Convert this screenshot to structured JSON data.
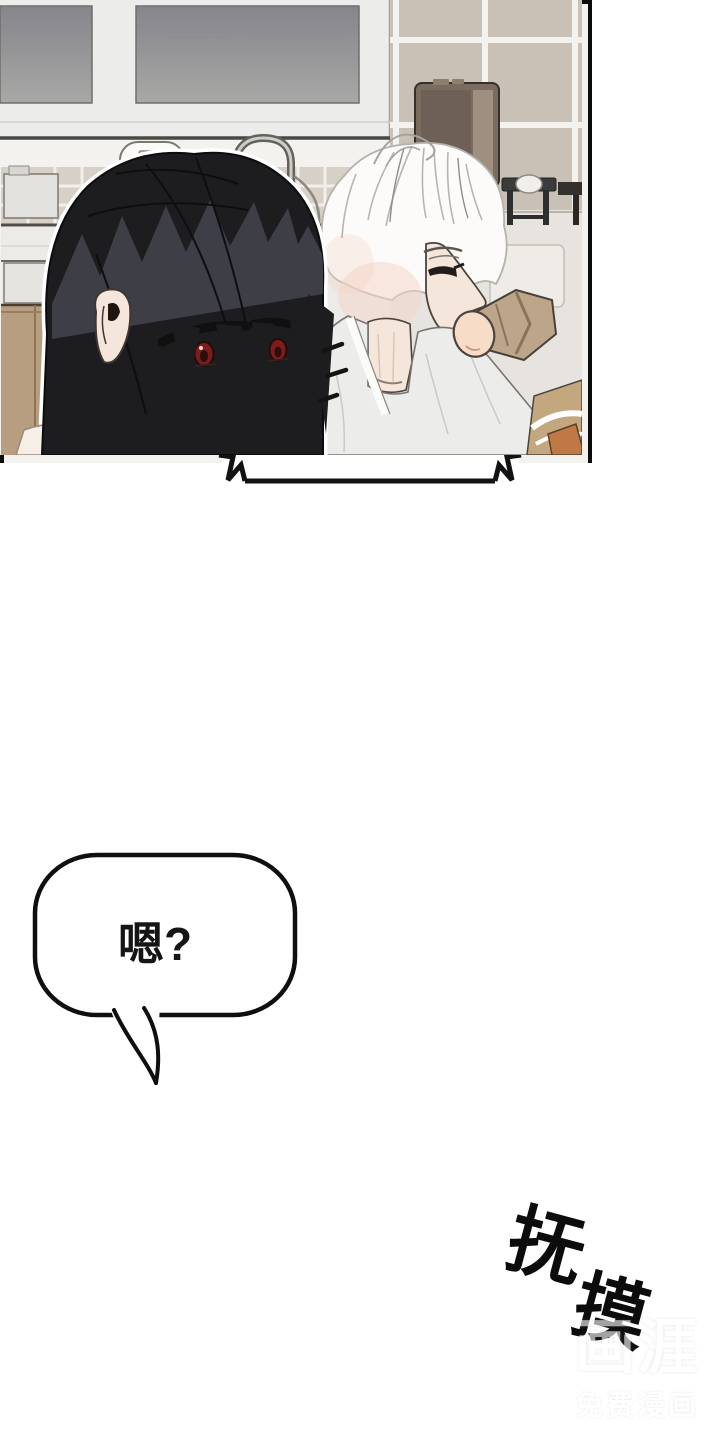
{
  "page": {
    "width": 720,
    "height": 1440,
    "type": "webtoon-comic-page"
  },
  "sfx_ring": {
    "full": "叮铃～",
    "chars": [
      "叮",
      "铃",
      "～"
    ],
    "meaning": "phone ringing sound effect"
  },
  "call_bubble": {
    "text": "是，请说!"
  },
  "reply_bubble": {
    "text": "嗯?"
  },
  "sfx_caress": {
    "full": "抚摸",
    "chars": [
      "抚",
      "摸"
    ],
    "meaning": "caress/petting sound effect"
  },
  "watermark": {
    "brand": "画涯",
    "tagline": "免费漫画"
  },
  "colors": {
    "paper": "#ffffff",
    "ink": "#0f0f10",
    "pane_top": "#85858b",
    "pane_bottom": "#a8a8a6",
    "window_frame": "#ecedeb",
    "tile_wall": "#c9c1b6",
    "tile_grout": "#f4f2ee",
    "backsplash": "#d7d0c6",
    "fridge_body": "#7b6c60",
    "fridge_light": "#9e8f81",
    "counter": "#edebe8",
    "floor": "#e7e4df",
    "wood_cabinet": "#b89e80",
    "stool": "#3b3b3b",
    "hair_black": "#1d1d20",
    "hair_highlight": "#42424a",
    "hair_white": "#fcfbf9",
    "skin": "#f5e6db",
    "blush": "#f3d4c6",
    "eye_red": "#7e1c1c",
    "shirt": "#ececea",
    "sleeve_tan": "#bda58a",
    "forearm_wood": "#c3a87f",
    "orange_accent": "#c07844"
  }
}
